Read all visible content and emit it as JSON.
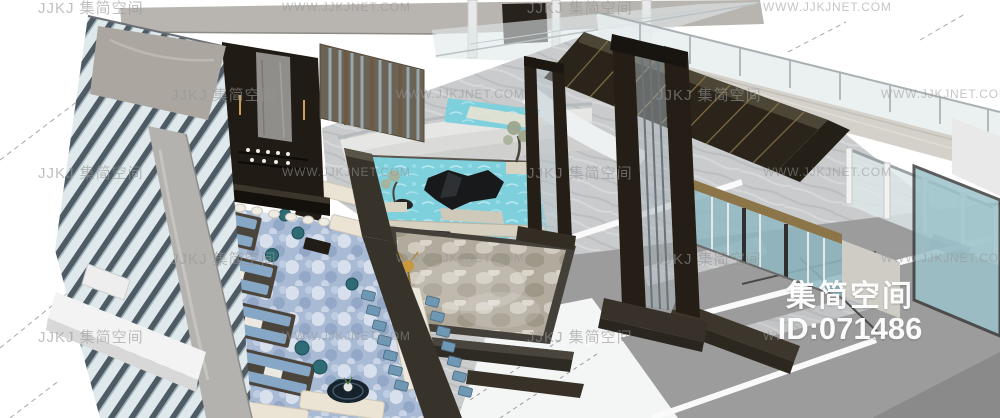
{
  "image": {
    "title": "3D hotel lobby interior render, aerial axonometric view",
    "width_px": 1000,
    "height_px": 418
  },
  "watermarks": {
    "logo_text": "JJKJ 集简空间",
    "url_text": "WWW.JJKJNET.COM",
    "brand_name": "集简空间",
    "brand_id": "ID:071486"
  },
  "palette": {
    "background": "#ffffff",
    "marble_floor": "#c9cbcc",
    "flat_floor_gray": "#9c9c9c",
    "dark_wood": "#241e16",
    "gold_trim": "#8c7548",
    "pond_water": "#7fd0dd",
    "carpet_blue": "#a9bad4",
    "chair_teal": "#6f98b4",
    "pouf_teal": "#2e6b74",
    "sofa_cream": "#ebe4d4",
    "glass": "#dfe8ea",
    "facade_fin": "#4e5b64",
    "watermark_gray": "#969696",
    "brand_watermark_white": "#ffffff"
  }
}
